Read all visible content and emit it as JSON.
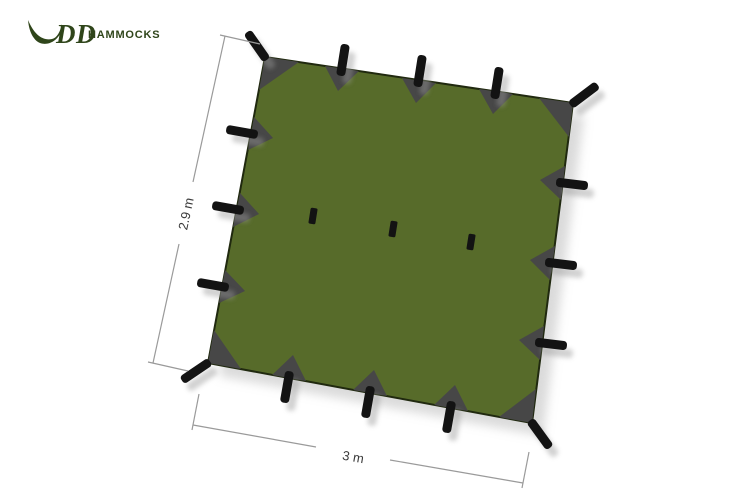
{
  "logo": {
    "dd": "DD",
    "hammocks": "HAMMOCKS"
  },
  "dimensions": {
    "height_label": "2.9 m",
    "width_label": "3 m"
  },
  "attachment_points": {
    "perimeter_toggles": 16,
    "center_loops": 3
  },
  "colors": {
    "tarp_green": "#576b2a",
    "tarp_outline": "#20290f",
    "patch_gray": "#474747",
    "toggle_black": "#131313",
    "toggle_shadow": "#9a9a9a",
    "tarp_shadow": "#bdbdbd",
    "logo_green": "#2f451a",
    "dim_line": "#9a9a9a",
    "dim_text": "#3a3a3a"
  }
}
